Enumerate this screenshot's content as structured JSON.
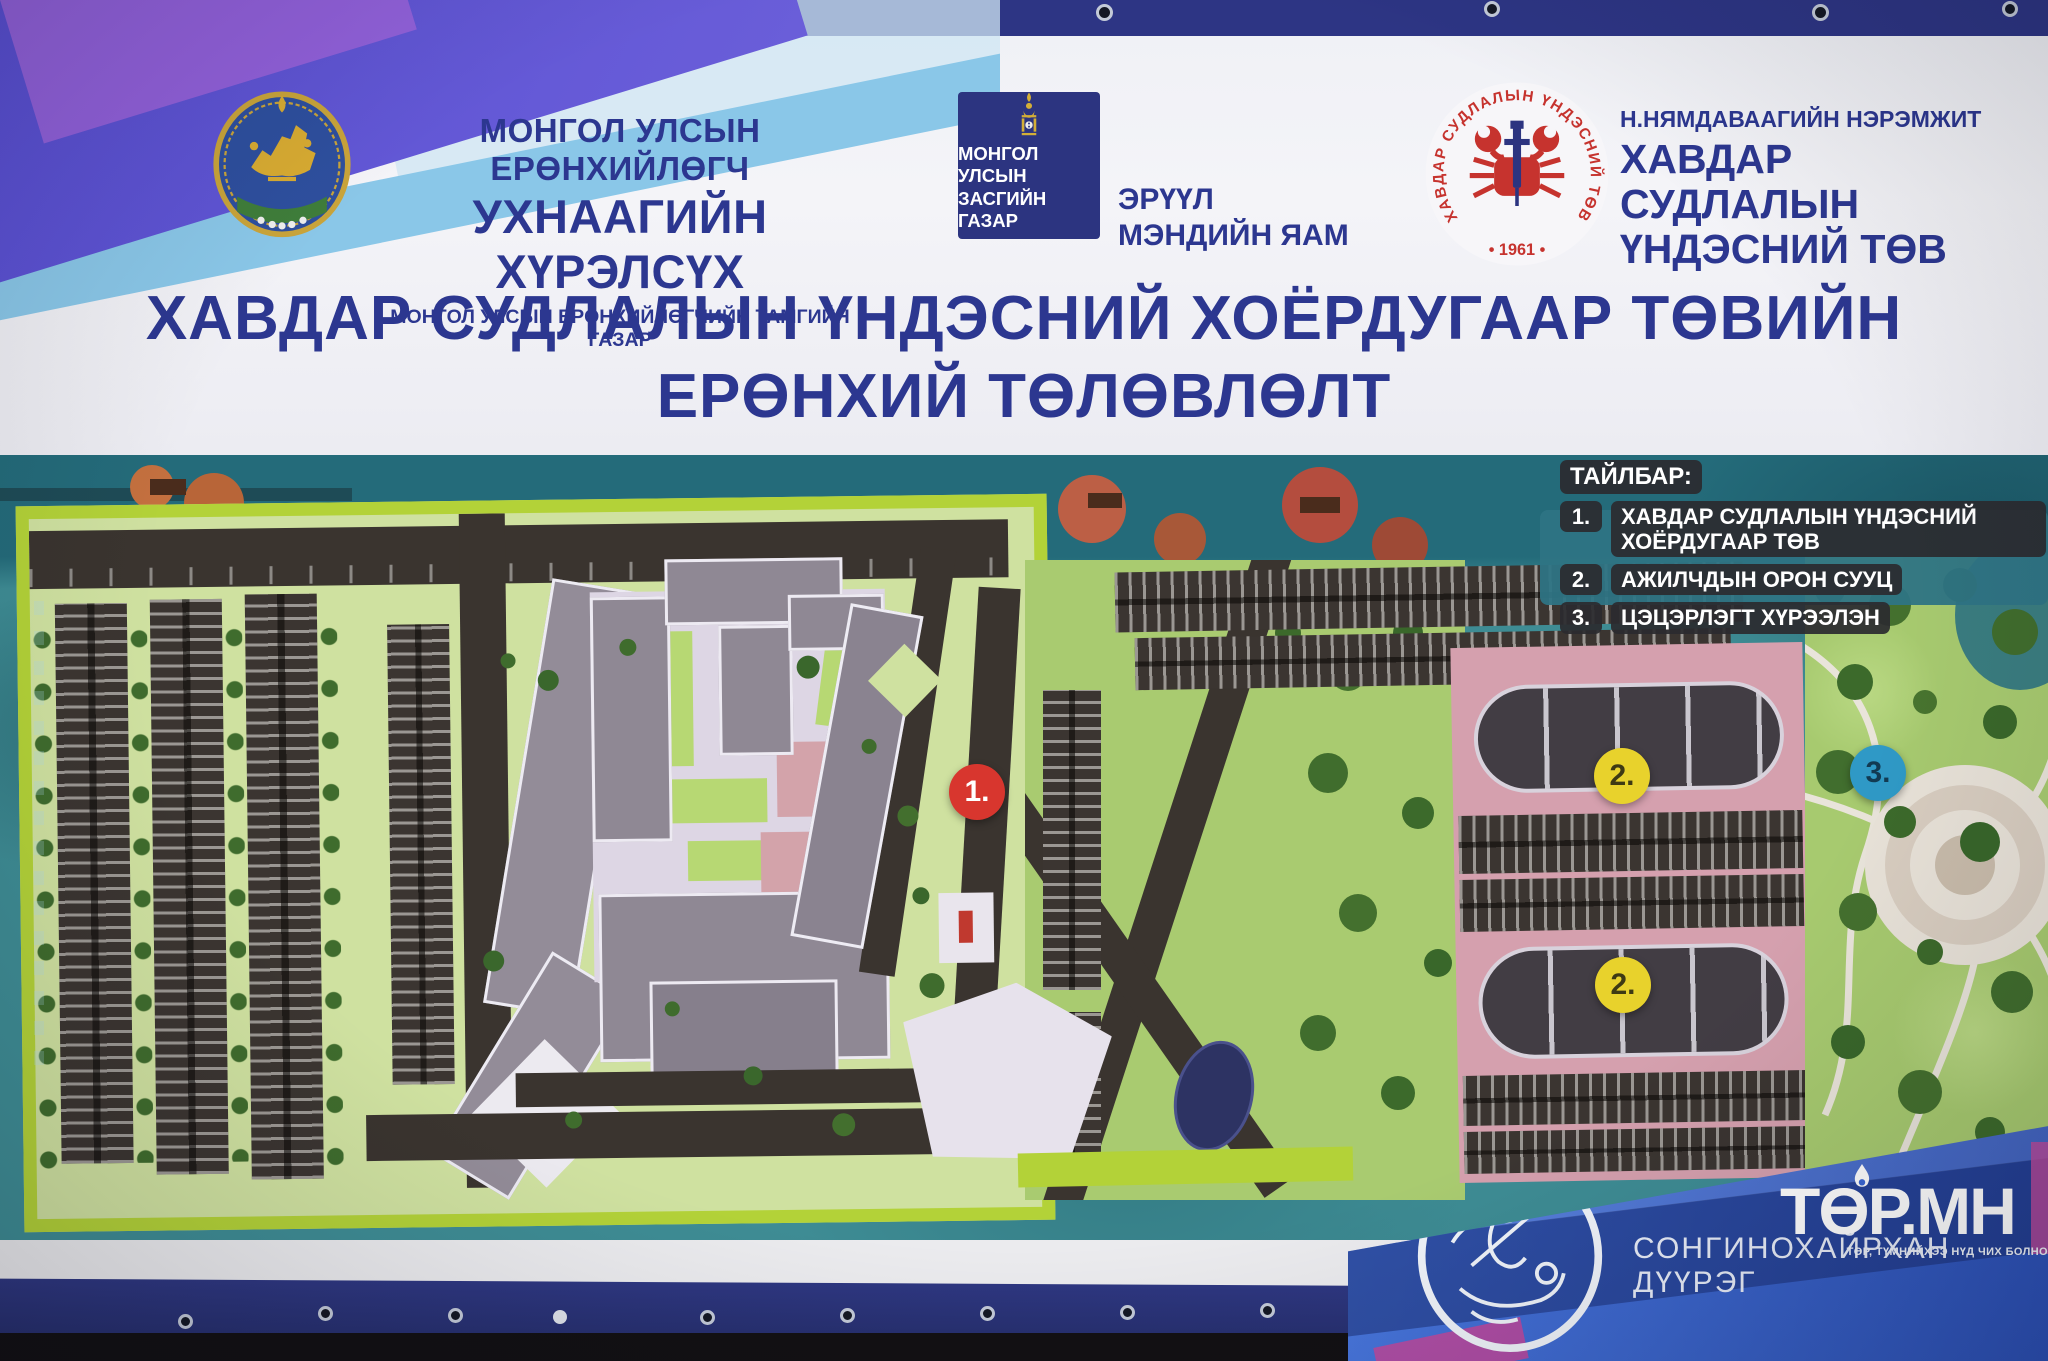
{
  "header": {
    "president": {
      "line1": "МОНГОЛ УЛСЫН ЕРӨНХИЙЛӨГЧ",
      "line2": "УХНААГИЙН ХҮРЭЛСҮХ",
      "line3": "МОНГОЛ УЛСЫН ЕРӨНХИЙЛӨГЧИЙН ТАМГИЙН ГАЗАР"
    },
    "government": {
      "sq_line1": "МОНГОЛ УЛСЫН",
      "sq_line2": "ЗАСГИЙН ГАЗАР",
      "ministry_line1": "ЭРҮҮЛ",
      "ministry_line2": "МЭНДИЙН ЯАМ"
    },
    "cancer": {
      "ring_text": "ХАВДАР СУДЛАЛЫН ҮНДЭСНИЙ ТӨВ",
      "year": "• 1961 •",
      "line1": "Н.НЯМДАВААГИЙН НЭРЭМЖИТ",
      "line2": "ХАВДАР СУДЛАЛЫН",
      "line3": "ҮНДЭСНИЙ ТӨВ"
    },
    "title_line1": "ХАВДАР СУДЛАЛЫН ҮНДЭСНИЙ ХОЁРДУГААР ТӨВИЙН",
    "title_line2": "ЕРӨНХИЙ ТӨЛӨВЛӨЛТ"
  },
  "legend": {
    "title": "ТАЙЛБАР:",
    "items": [
      {
        "num": "1.",
        "label": "ХАВДАР СУДЛАЛЫН ҮНДЭСНИЙ  ХОЁРДУГААР ТӨВ"
      },
      {
        "num": "2.",
        "label": "АЖИЛЧДЫН ОРОН СУУЦ"
      },
      {
        "num": "3.",
        "label": "ЦЭЦЭРЛЭГТ ХҮРЭЭЛЭН"
      }
    ]
  },
  "markers": [
    {
      "label": "1.",
      "color": "#d8362e"
    },
    {
      "label": "2.",
      "color": "#e8d22c"
    },
    {
      "label": "2.",
      "color": "#e8d22c"
    },
    {
      "label": "3.",
      "color": "#2f99c6"
    }
  ],
  "footer": {
    "district_name": "СОНГИНОХАЙРХАН ДҮҮРЭГ",
    "brand": "ТӨР.МН",
    "brand_tagline": "ТӨР, ТҮМНИЙХЭЭ НҮД ЧИХ БОЛНО"
  },
  "colors": {
    "title_navy": "#2c3790",
    "banner_white": "#f2f3f7",
    "map_teal": "#3e8c94",
    "site_border_lime": "#b3d238",
    "marker_red": "#d8362e",
    "marker_yellow": "#e8d22c",
    "marker_blue": "#2f99c6",
    "legend_pill": "#2b2b2f",
    "residential_pink": "#d5a0ae",
    "park_green": "#a7ca6f",
    "panel_blue": "#3a67d4",
    "hem_navy": "#2d3584",
    "gov_navy": "#2c3480",
    "logo_red": "#c6332e"
  }
}
